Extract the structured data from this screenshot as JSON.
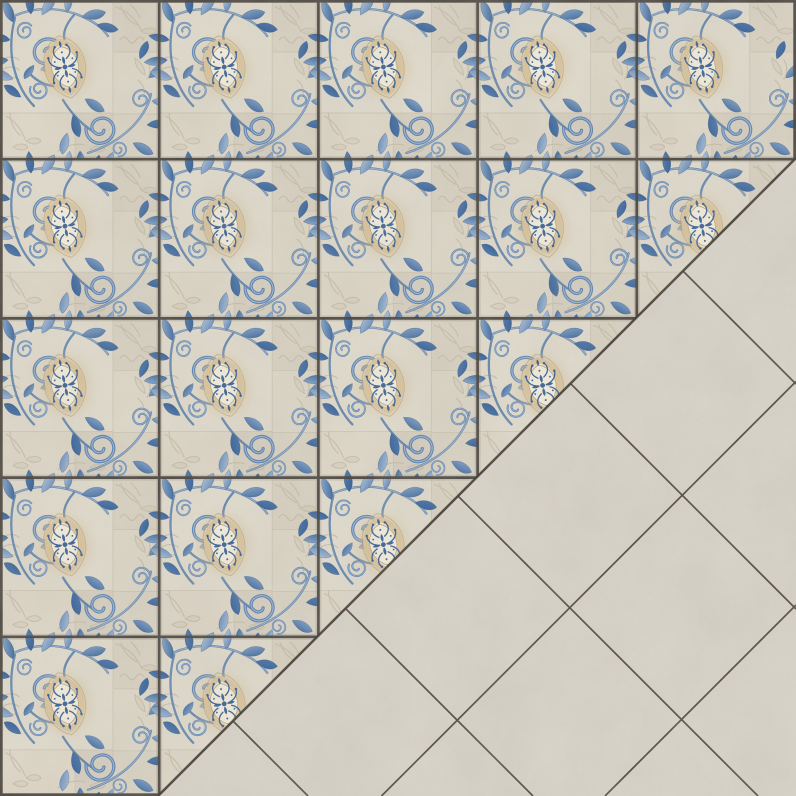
{
  "image": {
    "kind": "ceramic floor tile pattern texture",
    "canvas": {
      "width_px": 796,
      "height_px": 796
    },
    "grid": {
      "rows": 5,
      "cols": 5,
      "tile_size_px": 159.2
    },
    "decorated_region": {
      "area": "upper-left triangle",
      "full_tiles": 15,
      "diagonal_half_tiles": 4,
      "tile_style": "beige patchwork stoneware with embossed leaf reliefs, cobalt-blue watercolour acanthus scrolls in upper-left and lower-right corners, and a central cream-framed lens medallion filled with blue damask foliage",
      "grout": "dark straight grid lines between tiles and along top, left, right and bottom-left edges"
    },
    "plain_region": {
      "area": "lower-right triangle",
      "layout": "plain mottled greige stone tiles of the same size laid diagonally at 45 degrees",
      "boundary": "diagonal grout line from (796,158) to (158,796)",
      "diagonal_grout_lines_x_plus_y": [
        1177.5,
        1401
      ],
      "diagonal_grout_lines_x_minus_y": [
        412,
        187,
        -38,
        -263,
        -488
      ]
    }
  },
  "colors": {
    "tile_bg": "#dcd6c8",
    "tile_patch_a": "#ded9cb",
    "tile_patch_b": "#d6cfc0",
    "tile_patch_c": "#dbd5c6",
    "tile_patch_d": "#d7d1c2",
    "tile_patch_e": "#dcd5c6",
    "tile_patch_f": "#d4cdbe",
    "seam_line": "#c6bdab",
    "emboss_line": "#c3b9a4",
    "blue_deep": "#2d5890",
    "blue_mid": "#4f7aae",
    "blue_light": "#8fafd2",
    "blue_pale": "#bcccdf",
    "blue_stem": "#4d77a8",
    "cream_fill": "#f1ebdb",
    "tan_band": "#d8c29a",
    "tan_line": "#ad9569",
    "grout_dark": "#45403a",
    "lattice_line": "#38332b",
    "plain_bg": "#d6d2c7"
  }
}
